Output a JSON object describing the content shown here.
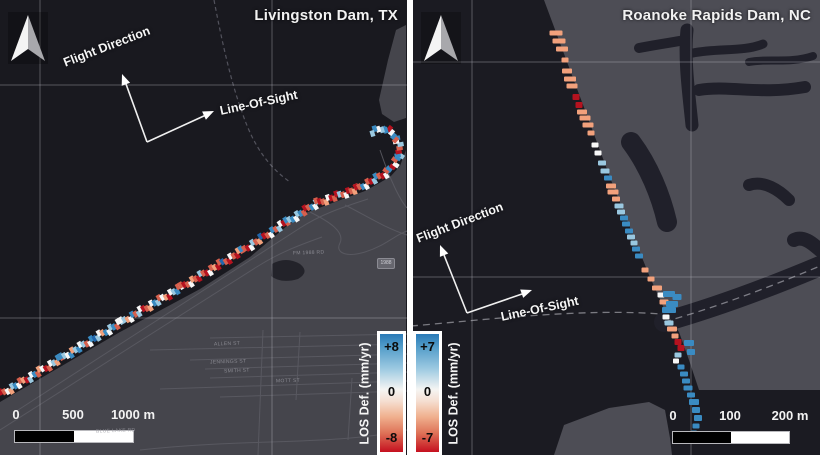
{
  "palette": {
    "d": "#b5121f",
    "r": "#d6604d",
    "p": "#f2a17c",
    "w": "#f7f7f7",
    "l": "#9ac8e0",
    "b": "#3a8bc2",
    "B": "#2166ac"
  },
  "left": {
    "title": "Livingston Dam, TX",
    "flight_label": "Flight Direction",
    "los_label": "Line-Of-Sight",
    "colorbar": {
      "label": "LOS Def. (mm/yr)",
      "top": "+8",
      "mid": "0",
      "bottom": "-8"
    },
    "scalebar": {
      "t0": "0",
      "t1": "500",
      "t2": "1000 m"
    },
    "shield": "1988",
    "street_labels": [
      {
        "t": "ALLEN ST",
        "x": 214,
        "y": 341
      },
      {
        "t": "JENNINGS ST",
        "x": 210,
        "y": 359
      },
      {
        "t": "SMITH ST",
        "x": 224,
        "y": 368
      },
      {
        "t": "MOTT ST",
        "x": 276,
        "y": 378
      },
      {
        "t": "FM 1988 RD",
        "x": 293,
        "y": 250
      },
      {
        "t": "BLUE LAKE RD",
        "x": 96,
        "y": 428
      }
    ],
    "chain_segments": [
      {
        "x1": 2,
        "y1": 394,
        "x2": 62,
        "y2": 358,
        "c": "drwplbwrpdlwbrpwdrwlpbr"
      },
      {
        "x1": 62,
        "y1": 358,
        "x2": 122,
        "y2": 322,
        "c": "blwbplbwlrwbBlwpbwlbrwl"
      },
      {
        "x1": 122,
        "y1": 322,
        "x2": 182,
        "y2": 287,
        "c": "wlpwbrlwdrpwblrwpdwlbrw"
      },
      {
        "x1": 182,
        "y1": 287,
        "x2": 242,
        "y2": 251,
        "c": "rdrwprdlrdwrpdrBrdwrdpr"
      },
      {
        "x1": 242,
        "y1": 251,
        "x2": 287,
        "y2": 222,
        "c": "brdwlrpBdrwbrlwdr"
      },
      {
        "x1": 287,
        "y1": 222,
        "x2": 317,
        "y2": 203,
        "c": "blbwlbrdrbwl"
      },
      {
        "x1": 317,
        "y1": 203,
        "x2": 357,
        "y2": 189,
        "c": "rdrpwdrdlrwdrpr"
      },
      {
        "x1": 357,
        "y1": 189,
        "x2": 388,
        "y2": 172,
        "c": "drbwrdlbrdwb"
      },
      {
        "x1": 388,
        "y1": 172,
        "x2": 400,
        "y2": 155,
        "c": "rbdwrbl"
      },
      {
        "x1": 400,
        "y1": 155,
        "x2": 397,
        "y2": 138,
        "c": "bdrlwb"
      },
      {
        "x1": 397,
        "y1": 138,
        "x2": 385,
        "y2": 128,
        "c": "rbwdb"
      },
      {
        "x1": 385,
        "y1": 128,
        "x2": 372,
        "y2": 132,
        "c": "blwbl"
      }
    ]
  },
  "right": {
    "title": "Roanoke Rapids Dam, NC",
    "flight_label": "Flight Direction",
    "los_label": "Line-Of-Sight",
    "colorbar": {
      "label": "LOS Def. (mm/yr)",
      "top": "+7",
      "mid": "0",
      "bottom": "-7"
    },
    "scalebar": {
      "t0": "0",
      "t1": "100",
      "t2": "200 m"
    },
    "points": [
      [
        143,
        33,
        13,
        5,
        "p"
      ],
      [
        146,
        41,
        13,
        5,
        "p"
      ],
      [
        149,
        49,
        12,
        5,
        "p"
      ],
      [
        152,
        60,
        7,
        5,
        "p"
      ],
      [
        154,
        71,
        10,
        5,
        "p"
      ],
      [
        157,
        79,
        12,
        5,
        "p"
      ],
      [
        159,
        86,
        11,
        5,
        "p"
      ],
      [
        163,
        97,
        7,
        6,
        "d"
      ],
      [
        166,
        105,
        7,
        6,
        "d"
      ],
      [
        169,
        112,
        10,
        5,
        "p"
      ],
      [
        172,
        118,
        11,
        5,
        "p"
      ],
      [
        175,
        125,
        11,
        5,
        "p"
      ],
      [
        178,
        133,
        7,
        5,
        "p"
      ],
      [
        182,
        145,
        7,
        5,
        "w"
      ],
      [
        185,
        153,
        7,
        5,
        "w"
      ],
      [
        189,
        163,
        8,
        5,
        "l"
      ],
      [
        192,
        171,
        9,
        5,
        "l"
      ],
      [
        195,
        178,
        8,
        5,
        "b"
      ],
      [
        198,
        186,
        10,
        5,
        "p"
      ],
      [
        200,
        192,
        11,
        5,
        "p"
      ],
      [
        203,
        199,
        8,
        5,
        "p"
      ],
      [
        206,
        206,
        9,
        5,
        "l"
      ],
      [
        208,
        212,
        8,
        5,
        "l"
      ],
      [
        211,
        218,
        8,
        5,
        "b"
      ],
      [
        213,
        224,
        8,
        5,
        "b"
      ],
      [
        216,
        231,
        8,
        5,
        "b"
      ],
      [
        218,
        237,
        8,
        5,
        "l"
      ],
      [
        221,
        243,
        7,
        5,
        "l"
      ],
      [
        223,
        249,
        8,
        5,
        "b"
      ],
      [
        226,
        256,
        8,
        5,
        "b"
      ],
      [
        232,
        270,
        7,
        5,
        "p"
      ],
      [
        238,
        279,
        7,
        5,
        "p"
      ],
      [
        244,
        288,
        10,
        5,
        "p"
      ],
      [
        248,
        295,
        7,
        5,
        "w"
      ],
      [
        256,
        294,
        12,
        6,
        "b"
      ],
      [
        264,
        297,
        9,
        6,
        "b"
      ],
      [
        251,
        302,
        9,
        5,
        "p"
      ],
      [
        259,
        304,
        12,
        6,
        "b"
      ],
      [
        256,
        310,
        14,
        6,
        "b"
      ],
      [
        253,
        317,
        7,
        5,
        "w"
      ],
      [
        256,
        323,
        9,
        5,
        "l"
      ],
      [
        259,
        329,
        10,
        5,
        "p"
      ],
      [
        262,
        336,
        7,
        5,
        "p"
      ],
      [
        265,
        342,
        7,
        6,
        "d"
      ],
      [
        268,
        348,
        7,
        6,
        "d"
      ],
      [
        276,
        343,
        10,
        6,
        "b"
      ],
      [
        278,
        352,
        8,
        6,
        "b"
      ],
      [
        265,
        355,
        7,
        5,
        "l"
      ],
      [
        263,
        361,
        6,
        5,
        "w"
      ],
      [
        268,
        367,
        7,
        5,
        "b"
      ],
      [
        271,
        374,
        8,
        5,
        "b"
      ],
      [
        273,
        381,
        8,
        5,
        "b"
      ],
      [
        275,
        388,
        9,
        5,
        "b"
      ],
      [
        278,
        395,
        8,
        5,
        "b"
      ],
      [
        281,
        402,
        10,
        6,
        "b"
      ],
      [
        283,
        410,
        8,
        6,
        "b"
      ],
      [
        285,
        418,
        8,
        6,
        "b"
      ],
      [
        283,
        426,
        7,
        5,
        "b"
      ],
      [
        281,
        433,
        6,
        5,
        "b"
      ]
    ]
  }
}
